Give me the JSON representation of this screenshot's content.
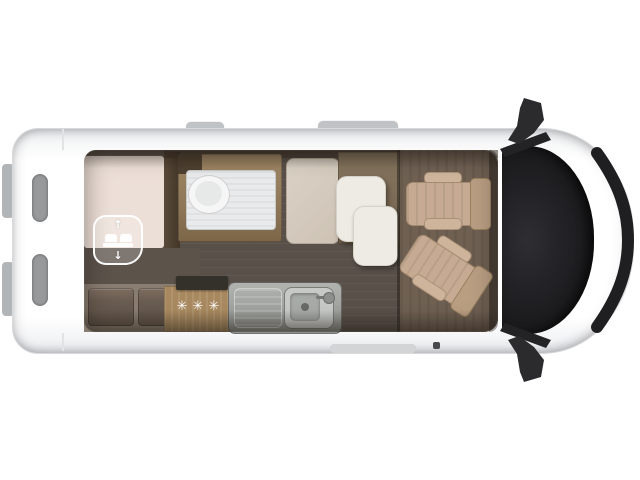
{
  "title": "Campervan floor plan — top view",
  "diagram": {
    "type": "floorplan-top-view",
    "vehicle": "camper van",
    "front_direction": "right",
    "regions": [
      {
        "id": "rear-bed",
        "label": "rear transverse bed with drop-down function"
      },
      {
        "id": "rear-bench",
        "label": "rear bench with two cushions"
      },
      {
        "id": "bathroom",
        "label": "bathroom with toilet and shower tray"
      },
      {
        "id": "wardrobe",
        "label": "wardrobe cabinet"
      },
      {
        "id": "dinette-table",
        "label": "extendable dinette table"
      },
      {
        "id": "kitchen",
        "label": "kitchen block with 3-burner hob and sink"
      },
      {
        "id": "cab",
        "label": "cab with two swivel seats"
      },
      {
        "id": "windshield",
        "label": "windshield / cab glazing"
      }
    ]
  },
  "icons": {
    "drop_down_bed": {
      "name": "drop-down-bed-icon",
      "up_arrow": "↑",
      "down_arrow": "↓"
    },
    "burners": {
      "name": "gas-burners-icon",
      "glyphs": "✳✳✳"
    }
  },
  "colors": {
    "body_white": "#fbfbfc",
    "glass_dark": "#1d1d1f",
    "interior_floor": "#585049",
    "bed_beige": "#ecdfd7",
    "bed_base_band": "#5c534b",
    "bench_cushion": "#675a4e",
    "bathroom_wood": "#96805f",
    "shower_white": "#e9eaeb",
    "wardrobe_beige": "#d4cabd",
    "table_white": "#edebe4",
    "kitchen_wood": "#a8895f",
    "stainless": "#a7aaa6",
    "cab_floor_brown": "#6f6052",
    "seat_beige": "#c6ab92",
    "mirror_black": "#2b2b2d"
  }
}
